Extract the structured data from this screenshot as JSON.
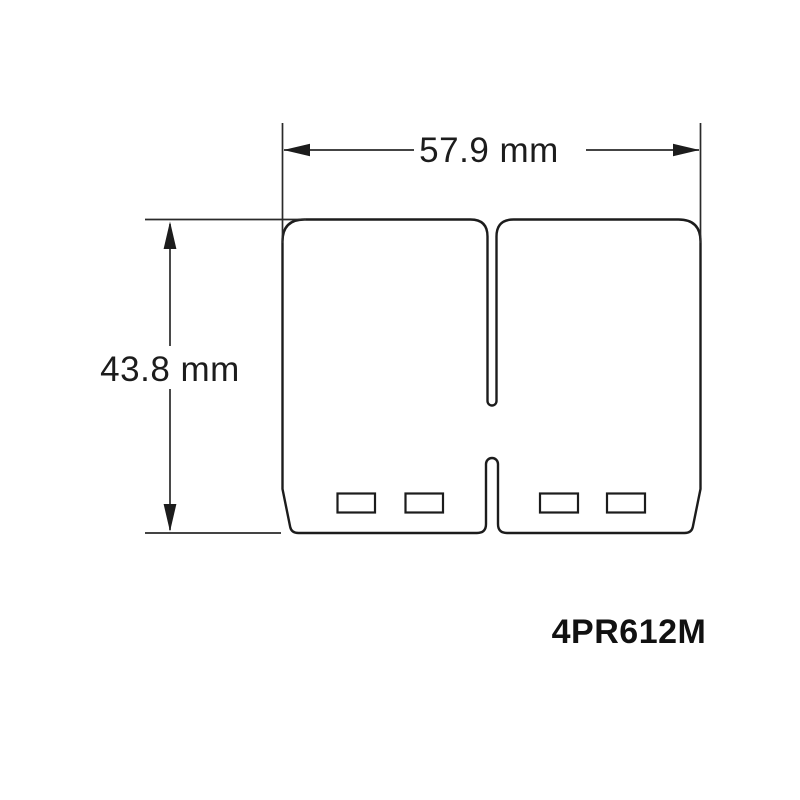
{
  "drawing": {
    "background": "#ffffff",
    "line_color": "#1c1c1c",
    "dimension_line_color": "#2a2a2a",
    "width_dimension_label": "57.9 mm",
    "height_dimension_label": "43.8 mm",
    "part_number": "4PR612M"
  }
}
